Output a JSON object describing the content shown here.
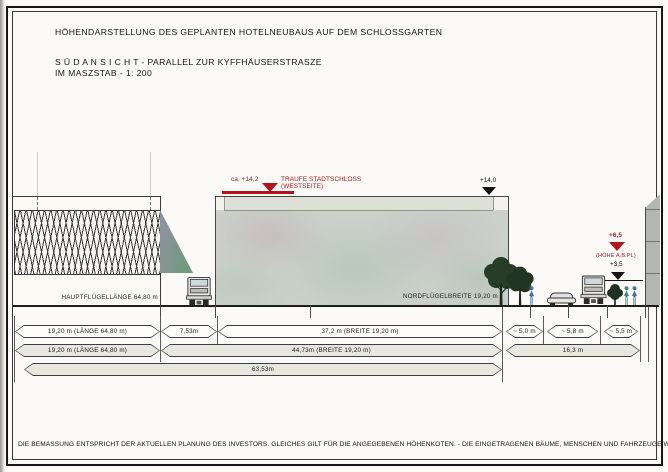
{
  "title": "HÖHENDARSTELLUNG DES GEPLANTEN HOTELNEUBAUS AUF DEM SCHLOSSGARTEN",
  "subtitle": "S Ü D A N S I C H T  -  PARALLEL ZUR KYFFHÄUSERSTRASZE",
  "scale_line": "IM MASZSTAB  -  1: 200",
  "drawing": {
    "left_wing_label": "HAUPTFLÜGELLÄNGE 64,80 m",
    "north_wing_label": "NORDFLÜGELBREITE 19,20 m",
    "traufe_value": "ca. +14,2",
    "traufe_label_line1": "TRAUFE STADTSCHLOSS",
    "traufe_label_line2": "(WESTSEITE)",
    "roof_marker": "+14,0",
    "right_marker_upper_value": "+6,5",
    "right_marker_upper_label": "(HÖHE A.B.PL)",
    "right_marker_lower_value": "+3,5"
  },
  "dimensions": {
    "row1": [
      "19,20 m  (LÄNGE 64,80 m)",
      "7,53m",
      "37,2 m (BREITE 19,20 m)",
      "~ 5,0 m",
      "~ 5,8 m",
      "~ 5,5 m"
    ],
    "row2": [
      "19,20 m  (LÄNGE 64,80 m)",
      "44,73m (BREITE 19,20 m)",
      "16,3 m"
    ],
    "row3": [
      "63,53m"
    ]
  },
  "footnote": "DIE BEMASSUNG ENTSPRICHT DER AKTUELLEN PLANUNG DES INVESTORS. GLEICHES GILT FÜR DIE ANGEGEBENEN HÖHENKOTEN.  -  DIE EINGETRAGENEN BÄUME, MENSCHEN UND FAHRZEUGE WURDEN DEM MASSSTAB ANGEPASST!",
  "colors": {
    "accent_red": "#b5121a",
    "building_fill": "#cbd1ca",
    "band_fill": "#e6e8e0"
  }
}
